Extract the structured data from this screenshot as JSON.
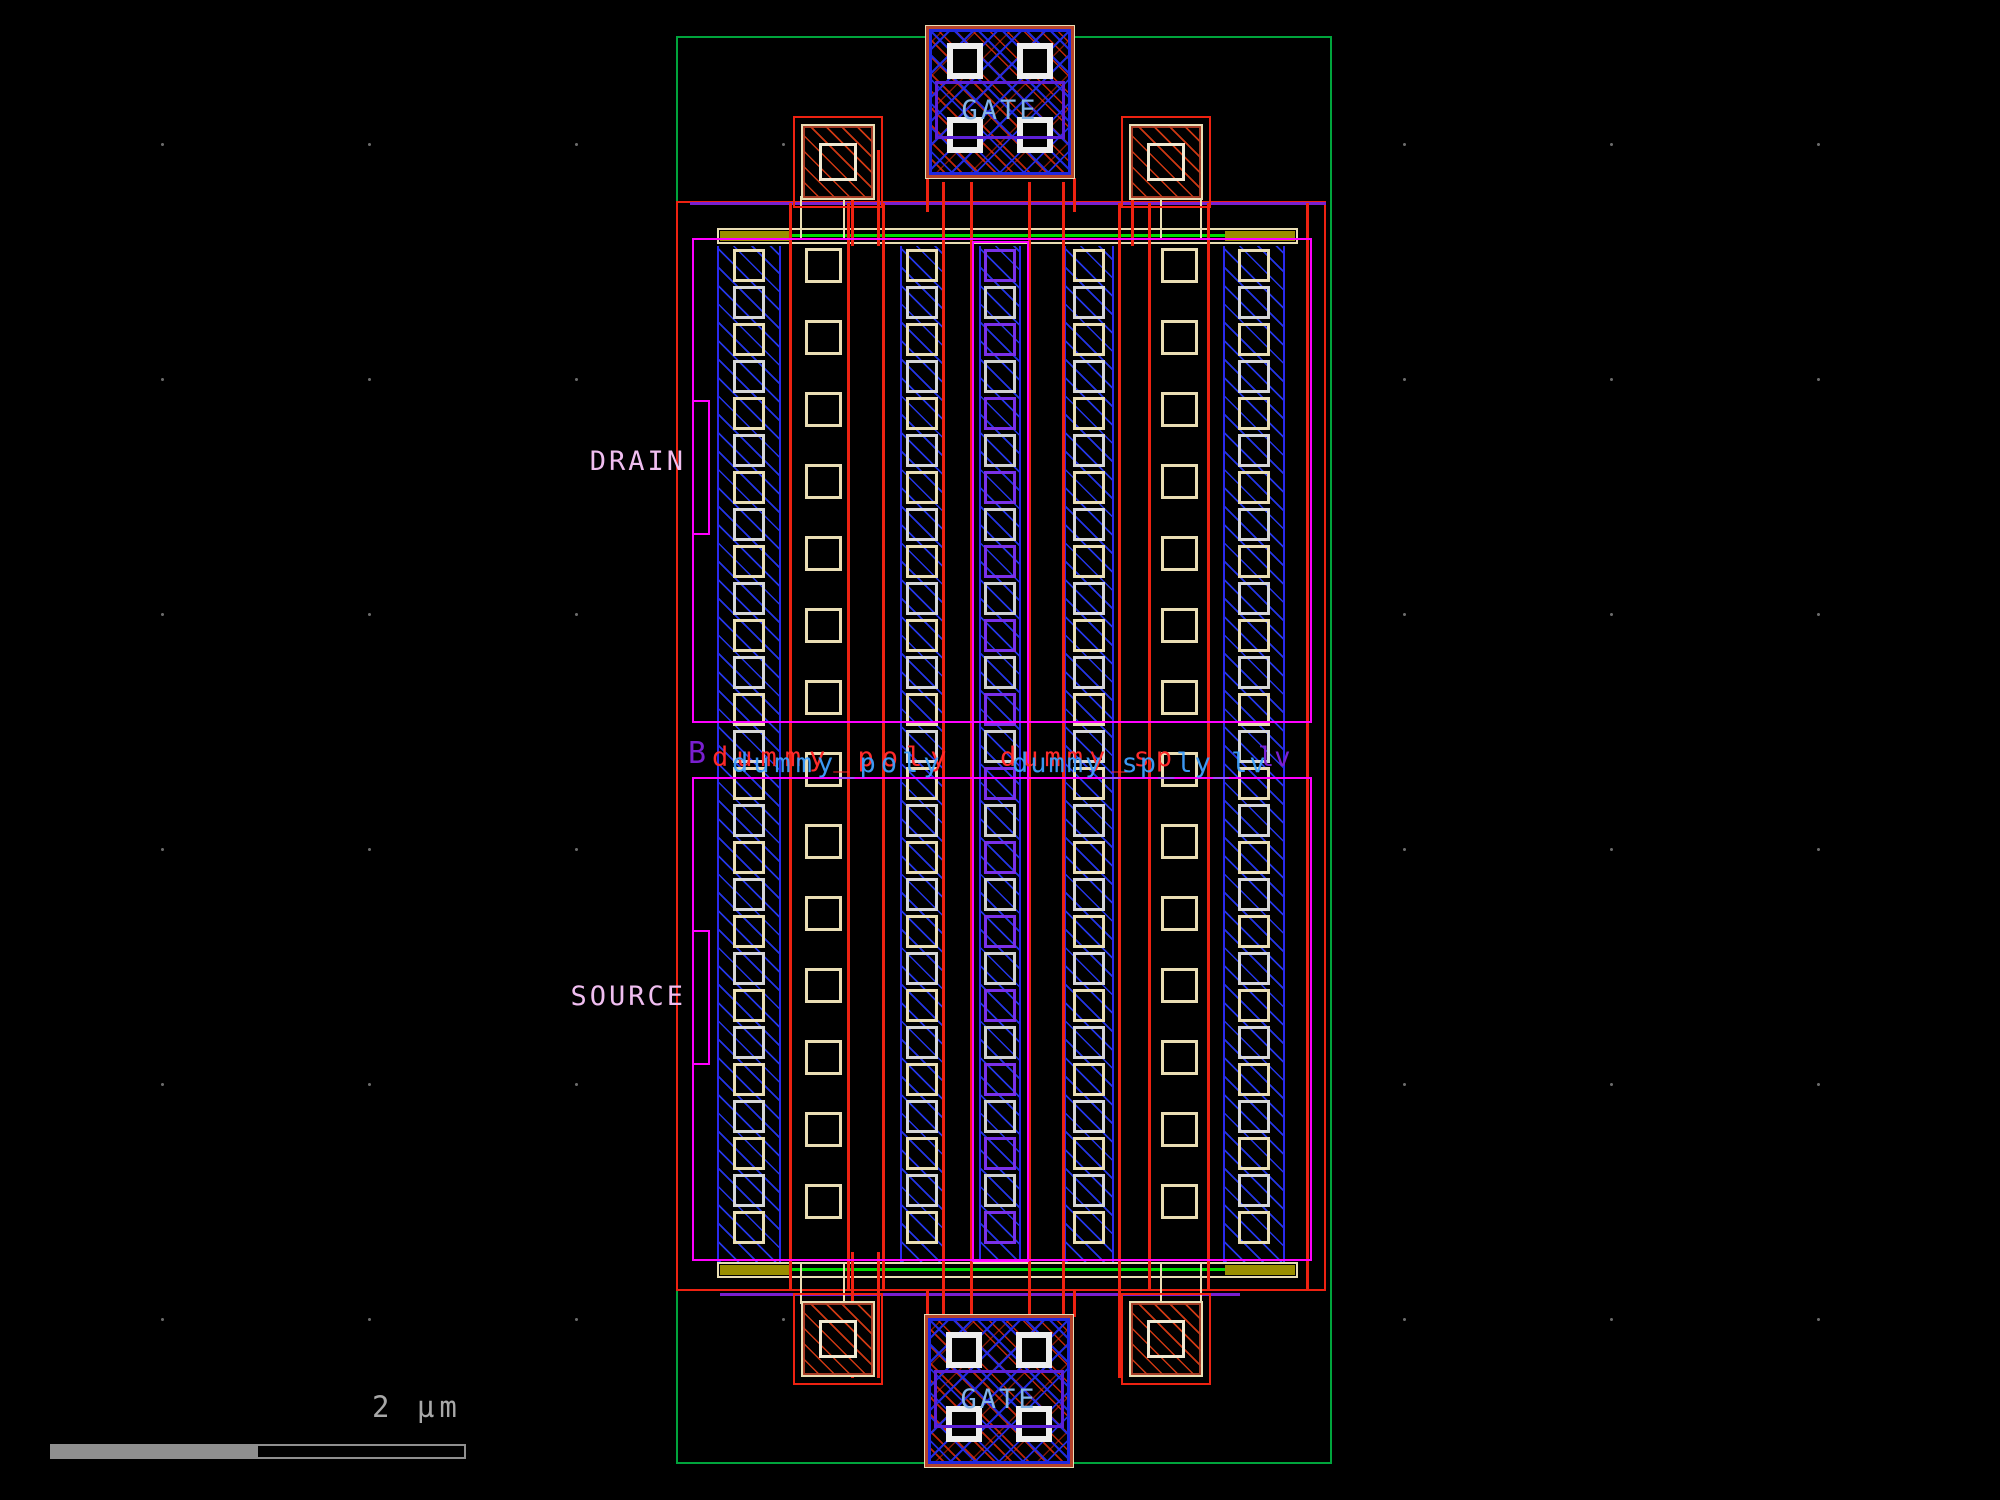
{
  "view": {
    "description": "IC layout viewer - interdigitated MOSFET"
  },
  "terminals": {
    "drain": "DRAIN",
    "source": "SOURCE",
    "gate_top": "GATE",
    "gate_bottom": "GATE"
  },
  "net_labels": {
    "b": "B",
    "left_red": "dummy_poly",
    "left_blue": "dummy_poly",
    "right_red": "dummy_sp",
    "right_blue": "dummy_sp_ly_lv",
    "right_purple": "lv"
  },
  "scale_bar": {
    "label": "2 µm"
  },
  "colors": {
    "guard-green": "#00a43c",
    "bright-green": "#00dd00",
    "red": "#ee2211",
    "brown-red": "#b5432a",
    "magenta": "#ff00ff",
    "purple": "#7a1fd0",
    "blue": "#2a2aee",
    "tan": "#e9ddb4",
    "olive": "#9a8e00",
    "contact-white": "#ededed",
    "chain-gray": "#d6d6d6",
    "chain-tan": "#e9ddb4",
    "chain-purple": "#7a30e8",
    "gate-text": "#82b4e8",
    "pin-label": "#f0bef0",
    "scale-gray": "#8f8f8f",
    "text-red": "#ff2a2a",
    "text-blue": "#3fa0ff"
  }
}
